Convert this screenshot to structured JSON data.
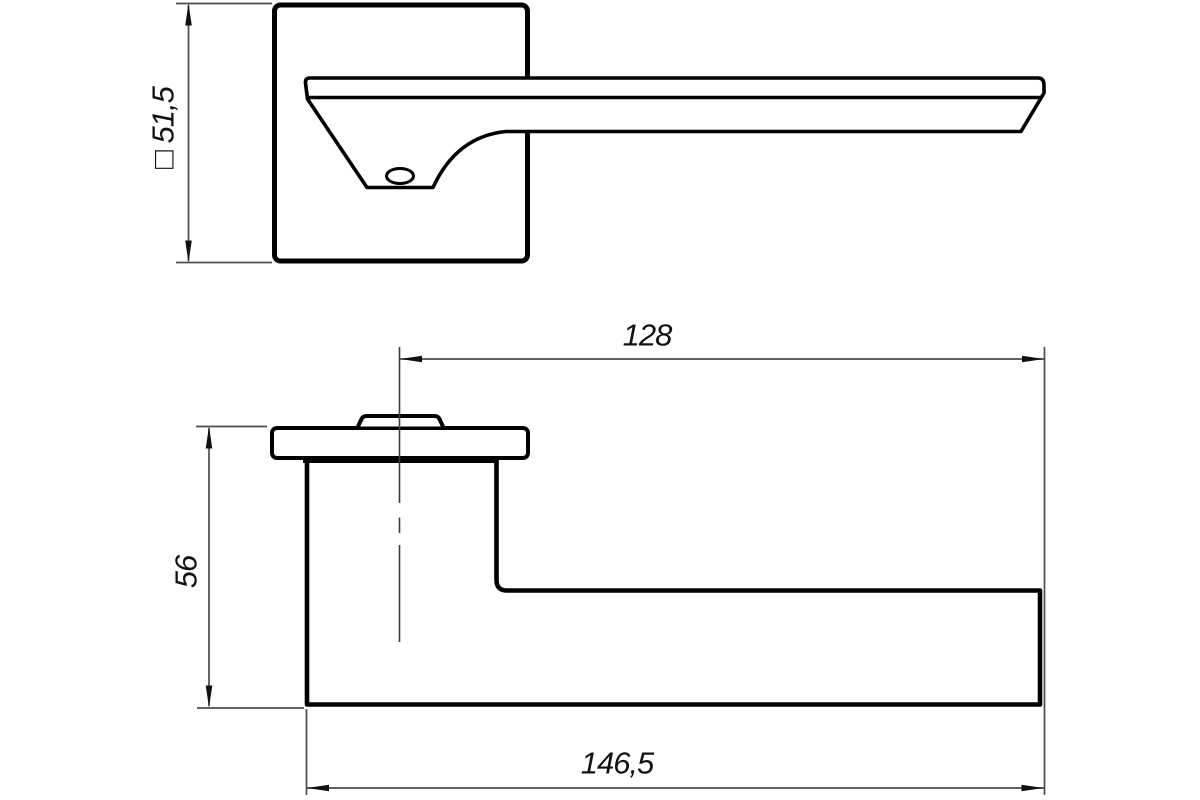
{
  "drawing": {
    "colors": {
      "background": "#ffffff",
      "outline": "#000000",
      "dimension_lines": "#4c4c4c",
      "text": "#111111"
    },
    "views": {
      "front": {
        "dimensions": {
          "rosette_size": {
            "label": "□ 51,5",
            "orientation": "vertical"
          }
        }
      },
      "side": {
        "dimensions": {
          "lever_length": {
            "label": "128",
            "orientation": "horizontal"
          },
          "handle_depth": {
            "label": "56",
            "orientation": "vertical"
          },
          "overall_length": {
            "label": "146,5",
            "orientation": "horizontal"
          }
        }
      }
    }
  }
}
